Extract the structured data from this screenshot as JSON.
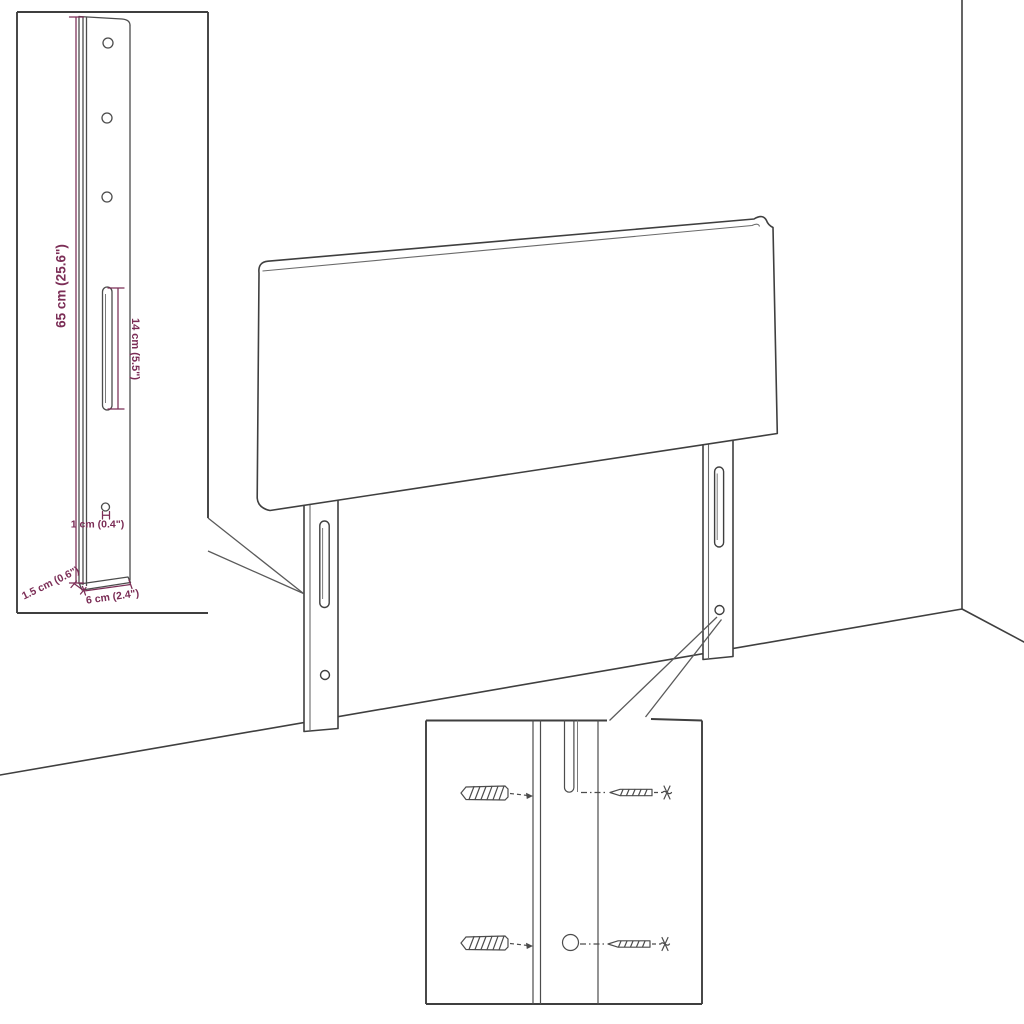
{
  "page": {
    "background": "#ffffff",
    "description": "Product dimension diagram of an upholstered headboard with two wall-mount legs shown in a room corner, with a bracket detail inset and a mounting-hardware detail inset"
  },
  "colors": {
    "outline": "#3f3f3f",
    "hardware_detail": "#4c4c4c",
    "dimension": "#7b2d56",
    "background": "#ffffff"
  },
  "main_drawing": {
    "name": "headboard-with-mounting-legs"
  },
  "bracket_inset": {
    "name": "mounting-leg-detail",
    "labels": {
      "height": "65 cm (25.6\")",
      "slot_length": "14 cm (5.5\")",
      "hole_diameter": "1 cm (0.4\")",
      "depth": "1.5 cm (0.6\")",
      "width": "6 cm (2.4\")"
    }
  },
  "hardware_inset": {
    "name": "wall-mounting-hardware-detail"
  }
}
